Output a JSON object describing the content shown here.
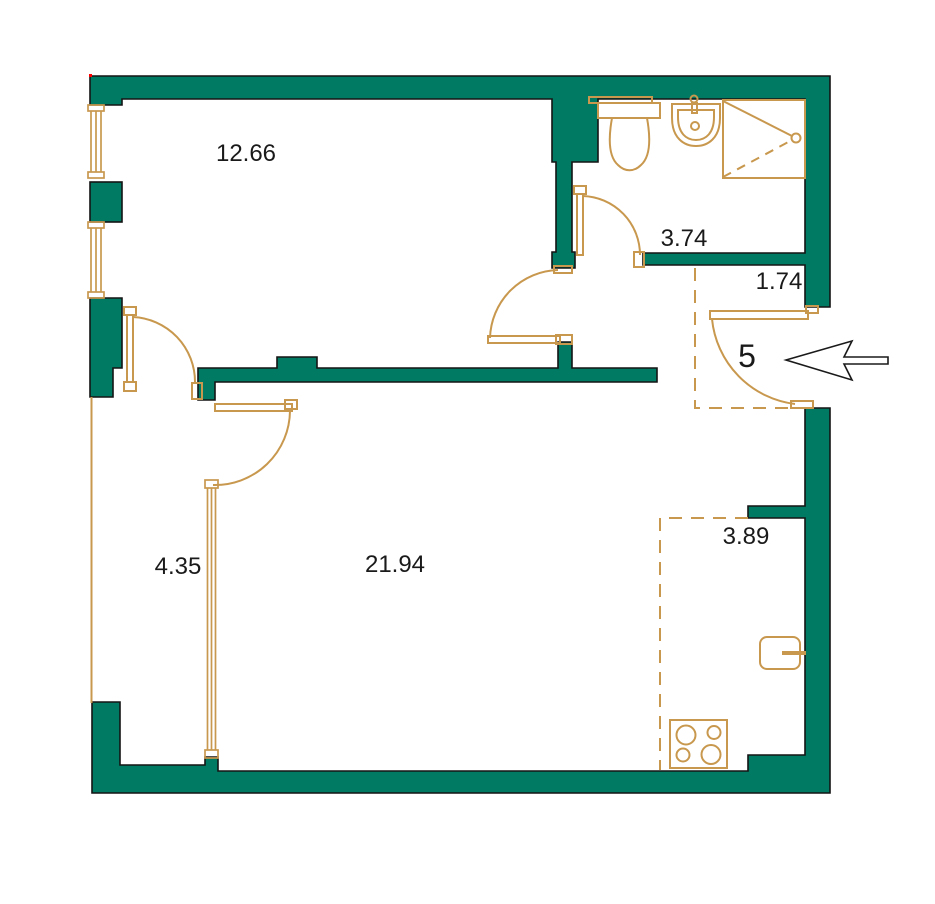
{
  "title": "Apartment floor plan",
  "unit": {
    "number": "5"
  },
  "rooms": [
    {
      "name": "bedroom",
      "area": "12.66"
    },
    {
      "name": "bathroom",
      "area": "3.74"
    },
    {
      "name": "hallway",
      "area": "1.74"
    },
    {
      "name": "storage",
      "area": "4.35"
    },
    {
      "name": "living-room",
      "area": "21.94"
    },
    {
      "name": "kitchen",
      "area": "3.89"
    }
  ],
  "fixtures": [
    "toilet",
    "sink",
    "shower",
    "kitchen-sink",
    "stove"
  ],
  "colors": {
    "wall": "#007a62",
    "fixture_line": "#c8984e",
    "outline": "#141414",
    "label_text": "#1a1a1a",
    "background": "#ffffff"
  }
}
